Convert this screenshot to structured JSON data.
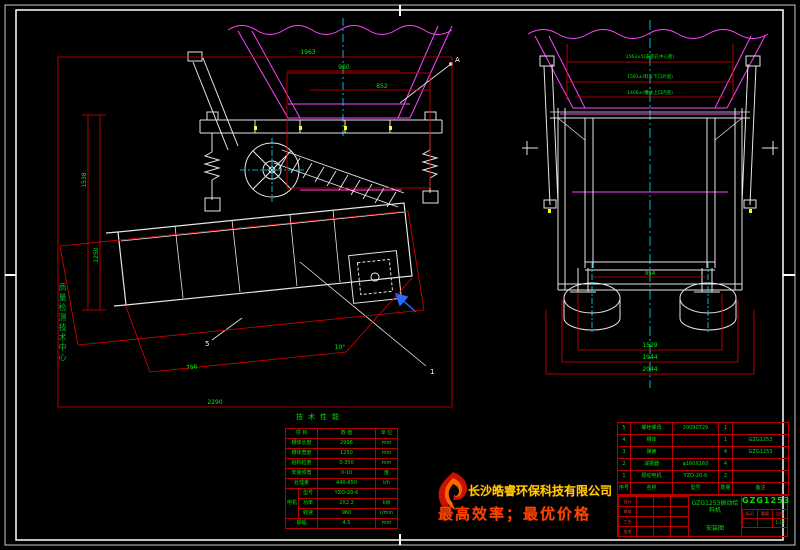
{
  "drawing": {
    "left_view": {
      "dim_top": "1963",
      "dim_mid": "960",
      "dim_inner": "852",
      "dim_left_outer": "1538",
      "dim_left_inner": "1250",
      "dim_bottom": "2290",
      "dim_slant": "756",
      "angle": "10°",
      "leader_1": "1",
      "leader_5": "5",
      "detail_label": "A"
    },
    "right_view": {
      "dim_top1": "1563±5(安装孔中心距)",
      "dim_top2": "1593±(料斗下口外宽)",
      "dim_top3": "1406±(槽体上口内宽)",
      "dim_inner": "954",
      "dim_bottom1": "1529",
      "dim_bottom2": "1944",
      "dim_bottom3": "2044"
    },
    "watermark": "质量检测技术中心"
  },
  "spec_table": {
    "title": "技术性能",
    "header": {
      "item": "项 目",
      "value": "数 值",
      "unit": "单 位"
    },
    "rows": [
      {
        "label": "槽体长度",
        "value": "2996",
        "unit": "mm"
      },
      {
        "label": "槽体宽度",
        "value": "1250",
        "unit": "mm"
      },
      {
        "label": "给料粒度",
        "value": "0-350",
        "unit": "mm"
      },
      {
        "label": "安装倾角",
        "value": "0-10",
        "unit": "度"
      },
      {
        "label": "处理量",
        "value": "440-650",
        "unit": "t/h"
      }
    ],
    "motor": {
      "group": "电机",
      "rows": [
        {
          "label": "型号",
          "value": "YZO-20-6",
          "unit": ""
        },
        {
          "label": "功率",
          "value": "2X2.2",
          "unit": "kW"
        },
        {
          "label": "转速",
          "value": "960",
          "unit": "r/min"
        }
      ]
    },
    "last_row": {
      "label": "振幅",
      "value": "4.5",
      "unit": "mm"
    }
  },
  "bom": {
    "header": [
      "序号",
      "名称",
      "型号",
      "数量",
      "备注"
    ],
    "rows": [
      [
        "5",
        "螺栓螺母",
        "20090729",
        "1",
        ""
      ],
      [
        "4",
        "槽体",
        "",
        "1",
        "GZG1253"
      ],
      [
        "3",
        "弹簧",
        "",
        "4",
        "GZG1253"
      ],
      [
        "2",
        "减振器",
        "φ160X160",
        "4",
        ""
      ],
      [
        "1",
        "振动电机",
        "YZO-20-6",
        "2",
        ""
      ]
    ]
  },
  "title_block": {
    "drawing_title": "GZG1253振动给料机",
    "drawing_type": "安装图",
    "model": "GZG1253",
    "scale": "1:10",
    "sig_labels": [
      "设计",
      "审核",
      "工艺",
      "批准"
    ],
    "mini_labels": [
      "标记",
      "重量",
      "比例"
    ]
  },
  "brand": {
    "company": "长沙皓睿环保科技有限公司",
    "slogan": "最高效率；最优价格"
  }
}
